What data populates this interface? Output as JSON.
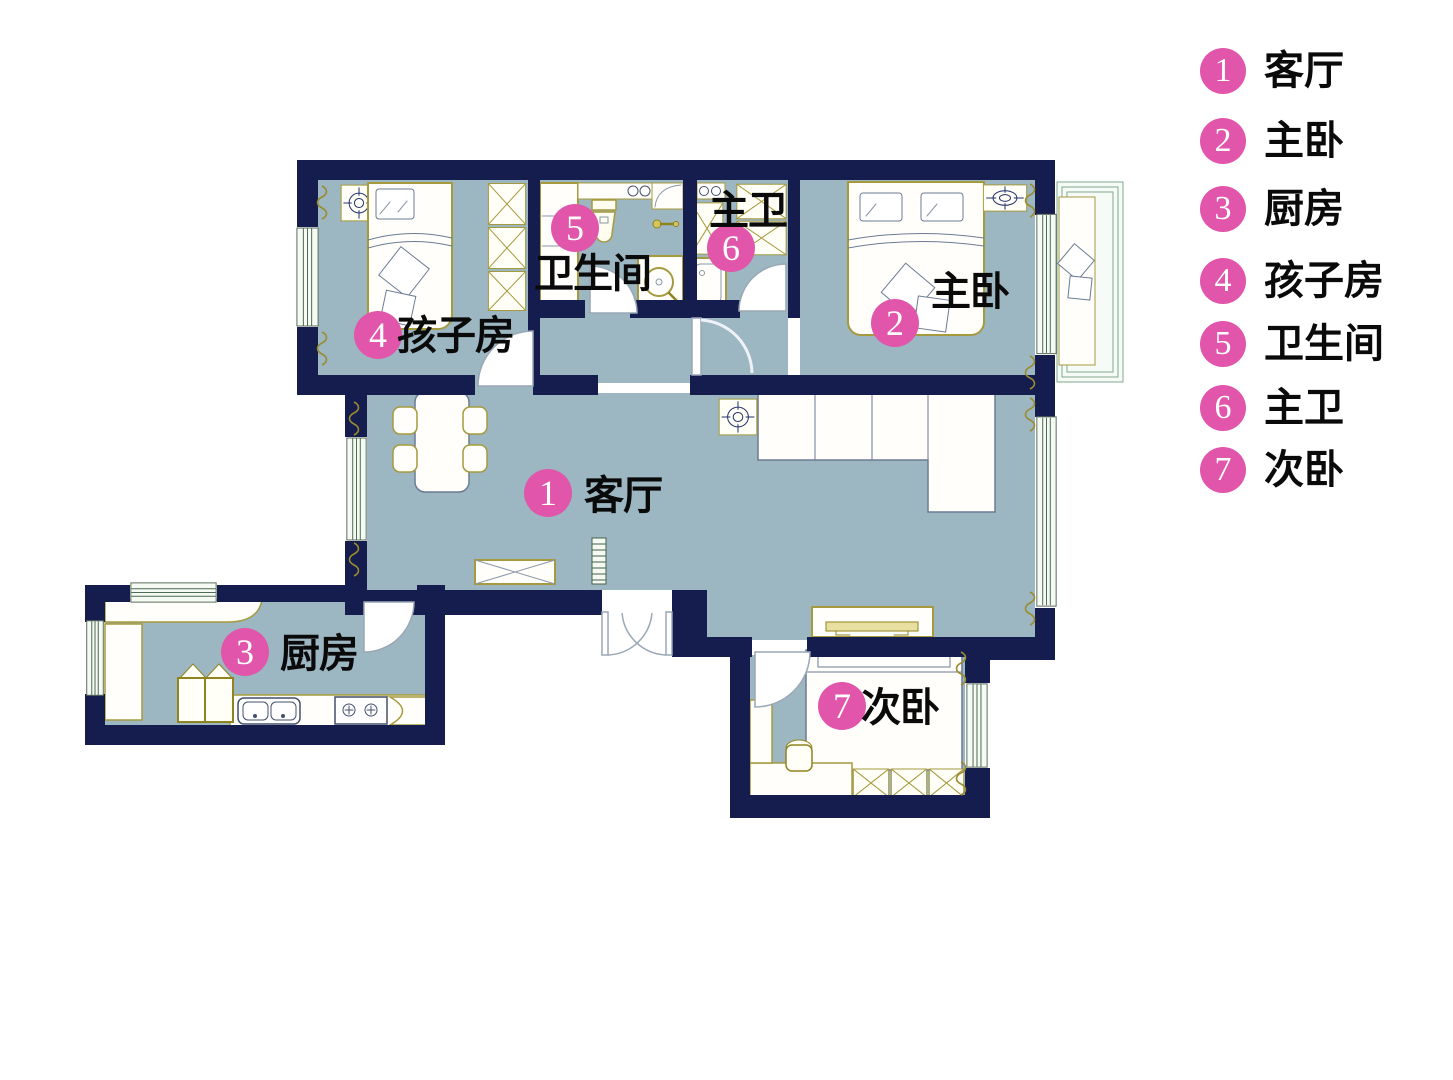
{
  "palette": {
    "wall_navy": "#151d4e",
    "floor_blue": "#9cb6c2",
    "badge_pink": "#e155ab",
    "furniture_gold": "#a69a3e",
    "window_green": "#4d6a55"
  },
  "legend": {
    "items": [
      {
        "num": "1",
        "label": "客厅"
      },
      {
        "num": "2",
        "label": "主卧"
      },
      {
        "num": "3",
        "label": "厨房"
      },
      {
        "num": "4",
        "label": "孩子房"
      },
      {
        "num": "5",
        "label": "卫生间"
      },
      {
        "num": "6",
        "label": "主卫"
      },
      {
        "num": "7",
        "label": "次卧"
      }
    ]
  },
  "plan": {
    "labels": [
      {
        "num": "1",
        "label": "客厅"
      },
      {
        "num": "2",
        "label": "主卧"
      },
      {
        "num": "3",
        "label": "厨房"
      },
      {
        "num": "4",
        "label": "孩子房"
      },
      {
        "num": "5",
        "label": "卫生间"
      },
      {
        "num": "6",
        "label": "主卫"
      },
      {
        "num": "7",
        "label": "次卧"
      }
    ]
  }
}
